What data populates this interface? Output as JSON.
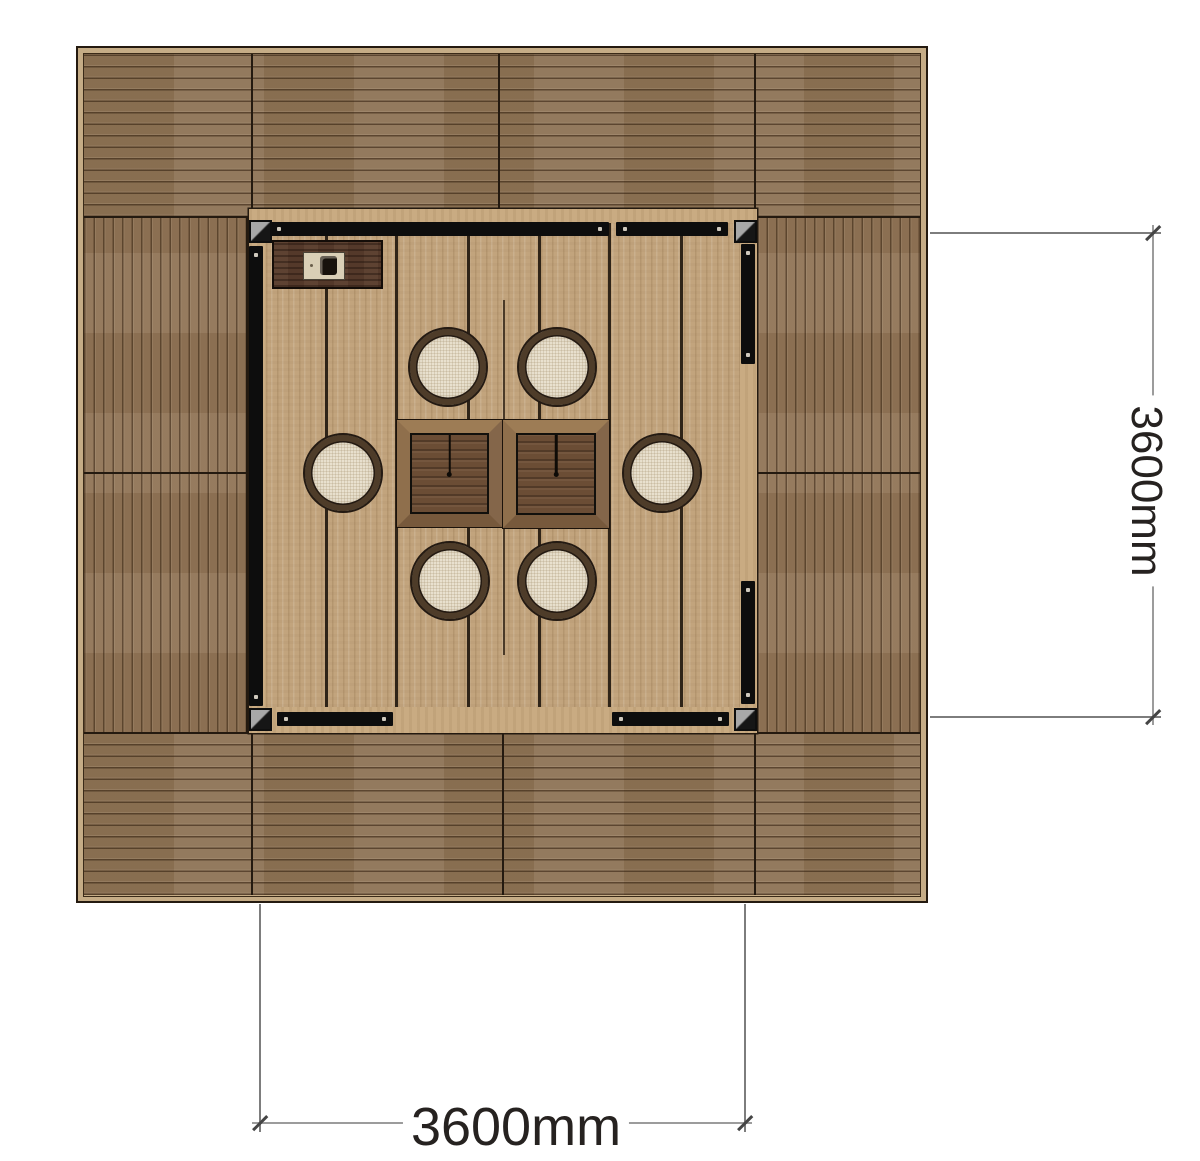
{
  "drawing": {
    "kind": "top-down plan of a square timber deck pavilion with central platform, two tables and six round stools"
  },
  "dimensions": {
    "right": {
      "label": "3600mm"
    },
    "bottom": {
      "label": "3600mm"
    }
  },
  "components": {
    "stool_count": 6,
    "table_count": 2,
    "corner_bracket_count": 4,
    "frame_beam_count": 7,
    "console_count": 1
  },
  "colors": {
    "background": "#ffffff",
    "outer_deck_wood": "#8d7355",
    "platform_wood": "#c2a47d",
    "platform_edge_wood": "#c9ab82",
    "table_top": "#6b4d35",
    "table_frame": "#8a6b48",
    "stool_cushion": "#e9e1cf",
    "stool_rim": "#4e3c29",
    "frame_beam": "#0d0d0d",
    "bracket_gray": "#a8a8a8",
    "console_wood": "#54392a",
    "dimension_line": "#9c9c9c",
    "dimension_text": "#262220"
  }
}
